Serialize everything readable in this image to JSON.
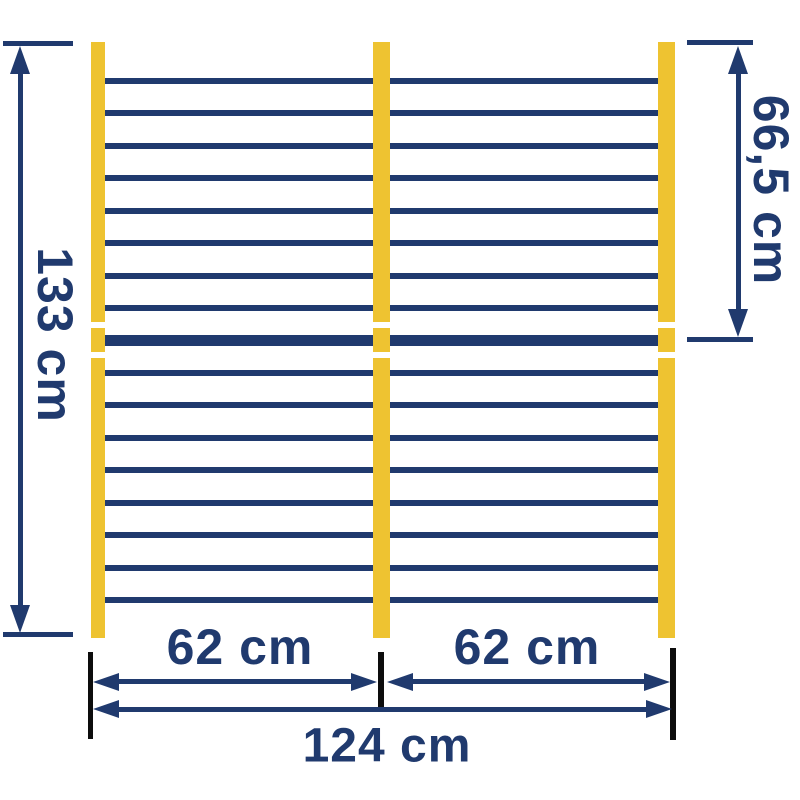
{
  "labels": {
    "height_total": "133 cm",
    "height_upper": "66,5 cm",
    "span_left": "62 cm",
    "span_right": "62 cm",
    "span_total": "124 cm"
  },
  "colors": {
    "navy": "#203a6e",
    "yellow": "#eec331",
    "black": "#0d0d0d",
    "background": "#ffffff"
  },
  "structure": {
    "posts": 3,
    "wires_above_rail": 8,
    "wires_below_rail": 8,
    "thick_rails": 1
  }
}
